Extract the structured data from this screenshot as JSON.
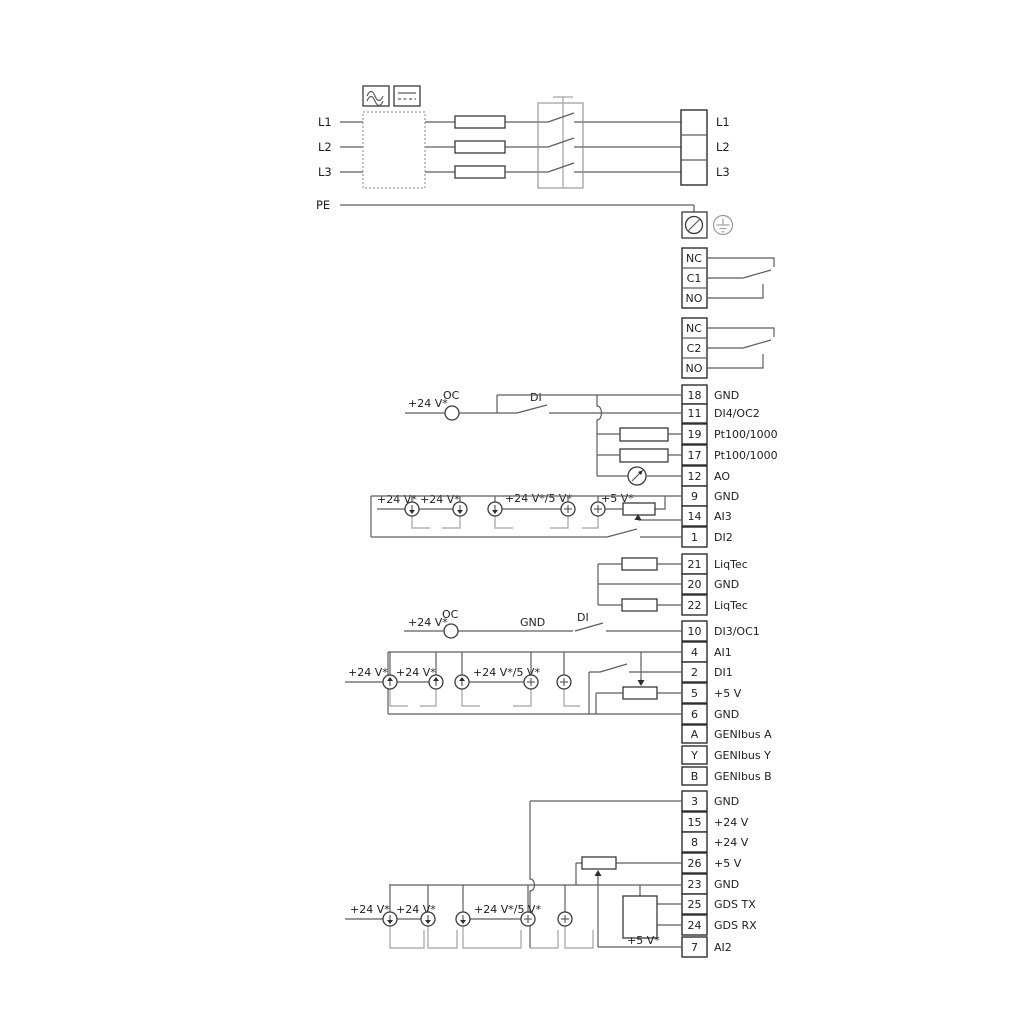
{
  "power": {
    "inputs": [
      "L1",
      "L2",
      "L3",
      "PE"
    ],
    "outputs": [
      "L1",
      "L2",
      "L3"
    ]
  },
  "relays": {
    "relay1": [
      "NC",
      "C1",
      "NO"
    ],
    "relay2": [
      "NC",
      "C2",
      "NO"
    ]
  },
  "terminals": [
    {
      "num": "18",
      "label": "GND"
    },
    {
      "num": "11",
      "label": "DI4/OC2"
    },
    {
      "num": "19",
      "label": "Pt100/1000"
    },
    {
      "num": "17",
      "label": "Pt100/1000"
    },
    {
      "num": "12",
      "label": "AO"
    },
    {
      "num": "9",
      "label": "GND"
    },
    {
      "num": "14",
      "label": "AI3"
    },
    {
      "num": "1",
      "label": "DI2"
    },
    {
      "num": "21",
      "label": "LiqTec"
    },
    {
      "num": "20",
      "label": "GND"
    },
    {
      "num": "22",
      "label": "LiqTec"
    },
    {
      "num": "10",
      "label": "DI3/OC1"
    },
    {
      "num": "4",
      "label": "AI1"
    },
    {
      "num": "2",
      "label": "DI1"
    },
    {
      "num": "5",
      "label": "+5 V"
    },
    {
      "num": "6",
      "label": "GND"
    },
    {
      "num": "A",
      "label": "GENIbus A"
    },
    {
      "num": "Y",
      "label": "GENIbus Y"
    },
    {
      "num": "B",
      "label": "GENIbus B"
    },
    {
      "num": "3",
      "label": "GND"
    },
    {
      "num": "15",
      "label": "+24 V"
    },
    {
      "num": "8",
      "label": "+24 V"
    },
    {
      "num": "26",
      "label": "+5 V"
    },
    {
      "num": "23",
      "label": "GND"
    },
    {
      "num": "25",
      "label": "GDS TX"
    },
    {
      "num": "24",
      "label": "GDS RX"
    },
    {
      "num": "7",
      "label": "AI2"
    }
  ],
  "annotations": {
    "v24": "+24 V*",
    "v24v5": "+24 V*/5 V*",
    "v5": "+5 V*",
    "oc": "OC",
    "di": "DI",
    "gnd": "GND"
  },
  "colors": {
    "wire": "#5d5d5d",
    "outline": "#2e2e2e",
    "background": "#ffffff"
  }
}
